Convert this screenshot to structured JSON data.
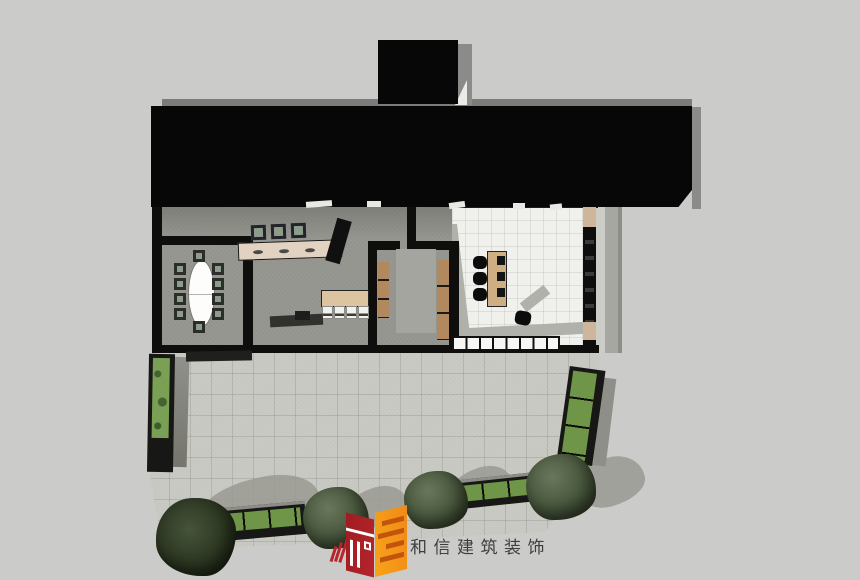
{
  "meta": {
    "kind": "architectural-top-view-rendering",
    "description": "SketchUp-style overhead rendering of a single-storey building: black flat roof, furnished interior, paved courtyard with hedge planters and trees"
  },
  "brand": {
    "name": "和信建筑装饰",
    "logo_icon": "hexin-cube-logo"
  },
  "palette": {
    "bg": "#cbcbc9",
    "roof": "#070707",
    "wall": "#0e0e0c",
    "floor": "#94948e",
    "white-floor": "#f0f0ed",
    "pavement": "#c7c7c1",
    "shadow": "#9a9a93",
    "counter-wood": "#e2d2c1",
    "desk-wood": "#cfae83",
    "panel-wood": "#b2895f",
    "table-wood": "#dcc4a0",
    "hedge": "#7aa055",
    "plant": "#6f9549",
    "tree": "#4b5a40",
    "seat": "#8e9c8c",
    "logo-red": "#b5252a",
    "logo-orange": "#f08a18",
    "text": "#3e3e3e"
  },
  "scene": {
    "rooms": [
      "conference-room",
      "bar-lounge",
      "panelled-corridor-room",
      "white-tile-office"
    ],
    "counts": {
      "conference_chairs": 10,
      "bar_stools": 3,
      "dining_chairs": 4,
      "office_chairs": 3,
      "desk_monitors": 3,
      "cabinet_segments": 8,
      "trees": 4,
      "planters": 4
    }
  }
}
